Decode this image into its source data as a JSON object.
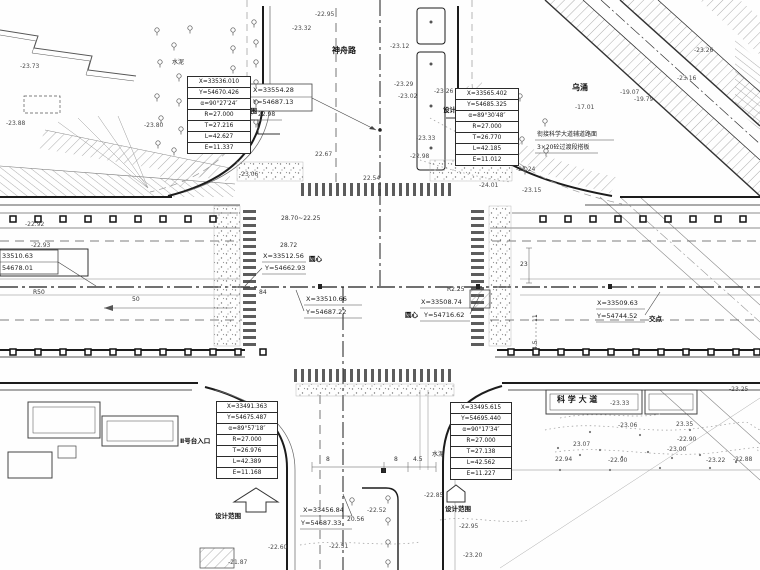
{
  "drawing": {
    "labels": [
      {
        "n": "road-name-shenzhou",
        "t": "神舟路",
        "x": 332,
        "y": 47,
        "c": "nm"
      },
      {
        "n": "river-name-wuchong",
        "t": "乌涌",
        "x": 572,
        "y": 84,
        "c": "nm"
      },
      {
        "n": "road-name-kexue-avenue",
        "t": "科 学 大 道",
        "x": 557,
        "y": 396,
        "c": "nm"
      },
      {
        "n": "entrance-label-1",
        "t": "Ⅰ号台入口",
        "x": 193,
        "y": 145,
        "c": "sm"
      },
      {
        "n": "entrance-label-2",
        "t": "Ⅱ号台入口",
        "x": 180,
        "y": 438,
        "c": "sm"
      },
      {
        "n": "design-scope-label-1",
        "t": "设计范围",
        "x": 231,
        "y": 108,
        "c": "sm"
      },
      {
        "n": "design-scope-label-2",
        "t": "设计范围",
        "x": 443,
        "y": 107,
        "c": "sm"
      },
      {
        "n": "design-scope-label-3",
        "t": "设计范围",
        "x": 215,
        "y": 513,
        "c": "sm"
      },
      {
        "n": "design-scope-label-4",
        "t": "设计范围",
        "x": 445,
        "y": 506,
        "c": "sm"
      },
      {
        "n": "note-line-1",
        "t": "衔接科学大道辅道路面",
        "x": 537,
        "y": 132,
        "c": "nt"
      },
      {
        "n": "note-line-2",
        "t": "3×20砼过渡段搭板",
        "x": 537,
        "y": 145,
        "c": "nt"
      },
      {
        "n": "circle-center-label-west",
        "t": "圆心",
        "x": 309,
        "y": 256,
        "c": "sm"
      },
      {
        "n": "circle-center-label-east",
        "t": "圆心",
        "x": 405,
        "y": 312,
        "c": "sm"
      },
      {
        "n": "intersection-point-label",
        "t": "交点",
        "x": 649,
        "y": 316,
        "c": "sm"
      },
      {
        "n": "cement-label-1",
        "t": "水泥",
        "x": 172,
        "y": 60,
        "c": "nt"
      },
      {
        "n": "cement-label-2",
        "t": "水泥",
        "x": 432,
        "y": 452,
        "c": "nt"
      },
      {
        "n": "coord-top-x",
        "t": "X=33554.28",
        "x": 253,
        "y": 87,
        "c": "co"
      },
      {
        "n": "coord-top-y",
        "t": "Y=54687.13",
        "x": 253,
        "y": 99,
        "c": "co"
      },
      {
        "n": "elev-top",
        "t": "22.98",
        "x": 258,
        "y": 112,
        "c": "dm"
      },
      {
        "n": "coord-west-center-x",
        "t": "X=33512.56",
        "x": 263,
        "y": 253,
        "c": "co"
      },
      {
        "n": "coord-west-center-y",
        "t": "Y=54662.93",
        "x": 265,
        "y": 265,
        "c": "co"
      },
      {
        "n": "coord-main-x",
        "t": "X=33510.66",
        "x": 306,
        "y": 296,
        "c": "co"
      },
      {
        "n": "coord-main-y",
        "t": "Y=54687.22",
        "x": 306,
        "y": 309,
        "c": "co"
      },
      {
        "n": "coord-east-center-x",
        "t": "X=33508.74",
        "x": 421,
        "y": 299,
        "c": "co"
      },
      {
        "n": "coord-east-center-y",
        "t": "Y=54716.62",
        "x": 424,
        "y": 312,
        "c": "co"
      },
      {
        "n": "coord-far-east-x",
        "t": "X=33509.63",
        "x": 597,
        "y": 300,
        "c": "co"
      },
      {
        "n": "coord-far-east-y",
        "t": "Y=54744.52",
        "x": 597,
        "y": 313,
        "c": "co"
      },
      {
        "n": "coord-south-x",
        "t": "X=33456.84",
        "x": 303,
        "y": 507,
        "c": "co"
      },
      {
        "n": "coord-south-y",
        "t": "Y=54687.33",
        "x": 301,
        "y": 520,
        "c": "co"
      },
      {
        "n": "coord-left-edge-x",
        "t": "33510.63",
        "x": 2,
        "y": 253,
        "c": "co"
      },
      {
        "n": "coord-left-edge-y",
        "t": "54678.01",
        "x": 2,
        "y": 265,
        "c": "co"
      },
      {
        "n": "dim-r50",
        "t": "R50",
        "x": 33,
        "y": 290,
        "c": "dm"
      },
      {
        "n": "dim-50",
        "t": "50",
        "x": 132,
        "y": 297,
        "c": "dm"
      },
      {
        "n": "dim-84",
        "t": "84",
        "x": 259,
        "y": 290,
        "c": "dm"
      },
      {
        "n": "dim-r225",
        "t": "R2.25",
        "x": 447,
        "y": 287,
        "c": "dm"
      },
      {
        "n": "dim-8a",
        "t": "8",
        "x": 326,
        "y": 457,
        "c": "dm"
      },
      {
        "n": "dim-8b",
        "t": "8",
        "x": 394,
        "y": 457,
        "c": "dm"
      },
      {
        "n": "dim-45a",
        "t": "4.5",
        "x": 413,
        "y": 457,
        "c": "dm"
      },
      {
        "n": "dim-23",
        "t": "23",
        "x": 520,
        "y": 262,
        "c": "dm"
      },
      {
        "n": "dim-11",
        "t": "11",
        "x": 533,
        "y": 322,
        "c": "dm",
        "r": -90
      },
      {
        "n": "dim-45b",
        "t": "4.5",
        "x": 533,
        "y": 350,
        "c": "dm",
        "r": -90
      },
      {
        "n": "dim-2870",
        "t": "28.70~22.25",
        "x": 281,
        "y": 216,
        "c": "dm"
      },
      {
        "n": "dim-2872",
        "t": "28.72",
        "x": 280,
        "y": 243,
        "c": "dm"
      },
      {
        "n": "dim-2056",
        "t": "20.56",
        "x": 347,
        "y": 517,
        "c": "dm"
      },
      {
        "n": "spot-elevation",
        "t": "-22.95",
        "x": 315,
        "y": 12,
        "c": "el"
      },
      {
        "n": "spot-elevation",
        "t": "-23.32",
        "x": 292,
        "y": 26,
        "c": "el"
      },
      {
        "n": "spot-elevation",
        "t": "-23.12",
        "x": 390,
        "y": 44,
        "c": "el"
      },
      {
        "n": "spot-elevation",
        "t": "-23.73",
        "x": 20,
        "y": 64,
        "c": "el"
      },
      {
        "n": "spot-elevation",
        "t": "-23.88",
        "x": 6,
        "y": 121,
        "c": "el"
      },
      {
        "n": "spot-elevation",
        "t": "-23.80",
        "x": 144,
        "y": 123,
        "c": "el"
      },
      {
        "n": "spot-elevation",
        "t": "-23.29",
        "x": 394,
        "y": 82,
        "c": "el"
      },
      {
        "n": "spot-elevation",
        "t": "-23.02",
        "x": 398,
        "y": 94,
        "c": "el"
      },
      {
        "n": "spot-elevation",
        "t": "-23.26",
        "x": 434,
        "y": 89,
        "c": "el"
      },
      {
        "n": "spot-elevation",
        "t": "-23.33",
        "x": 416,
        "y": 136,
        "c": "el"
      },
      {
        "n": "spot-elevation",
        "t": "-22.98",
        "x": 410,
        "y": 154,
        "c": "el"
      },
      {
        "n": "spot-elevation",
        "t": "-23.24",
        "x": 516,
        "y": 167,
        "c": "el"
      },
      {
        "n": "spot-elevation",
        "t": "-24.01",
        "x": 479,
        "y": 183,
        "c": "el"
      },
      {
        "n": "spot-elevation",
        "t": "-23.15",
        "x": 522,
        "y": 188,
        "c": "el"
      },
      {
        "n": "spot-elevation",
        "t": "-23.26",
        "x": 694,
        "y": 48,
        "c": "el"
      },
      {
        "n": "spot-elevation",
        "t": "-23.16",
        "x": 677,
        "y": 76,
        "c": "el"
      },
      {
        "n": "spot-elevation",
        "t": "-19.07",
        "x": 620,
        "y": 90,
        "c": "el"
      },
      {
        "n": "spot-elevation",
        "t": "-19.79",
        "x": 634,
        "y": 97,
        "c": "el"
      },
      {
        "n": "spot-elevation",
        "t": "-17.01",
        "x": 575,
        "y": 105,
        "c": "el"
      },
      {
        "n": "spot-elevation",
        "t": "-22.92",
        "x": 25,
        "y": 222,
        "c": "el"
      },
      {
        "n": "spot-elevation",
        "t": "-22.93",
        "x": 31,
        "y": 243,
        "c": "el"
      },
      {
        "n": "spot-elevation",
        "t": "22.67",
        "x": 315,
        "y": 152,
        "c": "el"
      },
      {
        "n": "spot-elevation",
        "t": "22.54",
        "x": 363,
        "y": 176,
        "c": "el"
      },
      {
        "n": "spot-elevation",
        "t": "-23.06",
        "x": 239,
        "y": 172,
        "c": "el"
      },
      {
        "n": "spot-elevation",
        "t": "-22.52",
        "x": 367,
        "y": 508,
        "c": "el"
      },
      {
        "n": "spot-elevation",
        "t": "-22.85",
        "x": 424,
        "y": 493,
        "c": "el"
      },
      {
        "n": "spot-elevation",
        "t": "-22.95",
        "x": 459,
        "y": 524,
        "c": "el"
      },
      {
        "n": "spot-elevation",
        "t": "-23.20",
        "x": 463,
        "y": 553,
        "c": "el"
      },
      {
        "n": "spot-elevation",
        "t": "-22.51",
        "x": 329,
        "y": 544,
        "c": "el"
      },
      {
        "n": "spot-elevation",
        "t": "-22.60",
        "x": 268,
        "y": 545,
        "c": "el"
      },
      {
        "n": "spot-elevation",
        "t": "-21.87",
        "x": 228,
        "y": 560,
        "c": "el"
      },
      {
        "n": "spot-elevation",
        "t": "-23.33",
        "x": 610,
        "y": 401,
        "c": "el"
      },
      {
        "n": "spot-elevation",
        "t": "23.35",
        "x": 676,
        "y": 422,
        "c": "el"
      },
      {
        "n": "spot-elevation",
        "t": "-23.06",
        "x": 618,
        "y": 423,
        "c": "el"
      },
      {
        "n": "spot-elevation",
        "t": "23.07",
        "x": 573,
        "y": 442,
        "c": "el"
      },
      {
        "n": "spot-elevation",
        "t": "-22.90",
        "x": 677,
        "y": 437,
        "c": "el"
      },
      {
        "n": "spot-elevation",
        "t": "-23.00",
        "x": 667,
        "y": 447,
        "c": "el"
      },
      {
        "n": "spot-elevation",
        "t": "-22.90",
        "x": 608,
        "y": 458,
        "c": "el"
      },
      {
        "n": "spot-elevation",
        "t": "22.94",
        "x": 555,
        "y": 457,
        "c": "el"
      },
      {
        "n": "spot-elevation",
        "t": "-23.22",
        "x": 706,
        "y": 458,
        "c": "el"
      },
      {
        "n": "spot-elevation",
        "t": "-22.88",
        "x": 733,
        "y": 457,
        "c": "el"
      },
      {
        "n": "spot-elevation",
        "t": "-23.25",
        "x": 729,
        "y": 387,
        "c": "el"
      }
    ],
    "curve_tables": [
      {
        "name": "curve-table-northwest",
        "x": 187,
        "y": 76,
        "w": 64,
        "rows": [
          "X=33536.010",
          "Y=54670.426",
          "α=90°27′24″",
          "R=27.000",
          "T=27.216",
          "L=42.627",
          "E=11.337"
        ]
      },
      {
        "name": "curve-table-northeast",
        "x": 455,
        "y": 88,
        "w": 64,
        "rows": [
          "X=33565.402",
          "Y=54685.325",
          "α=89°30′48″",
          "R=27.000",
          "T=26.770",
          "L=42.185",
          "E=11.012"
        ]
      },
      {
        "name": "curve-table-southwest",
        "x": 216,
        "y": 401,
        "w": 62,
        "rows": [
          "X=33491.363",
          "Y=54675.487",
          "α=89°57′18″",
          "R=27.000",
          "T=26.976",
          "L=42.389",
          "E=11.168"
        ]
      },
      {
        "name": "curve-table-southeast",
        "x": 450,
        "y": 402,
        "w": 62,
        "rows": [
          "X=33495.615",
          "Y=54695.440",
          "α=90°17′34″",
          "R=27.000",
          "T=27.138",
          "L=42.562",
          "E=11.227"
        ]
      }
    ]
  }
}
